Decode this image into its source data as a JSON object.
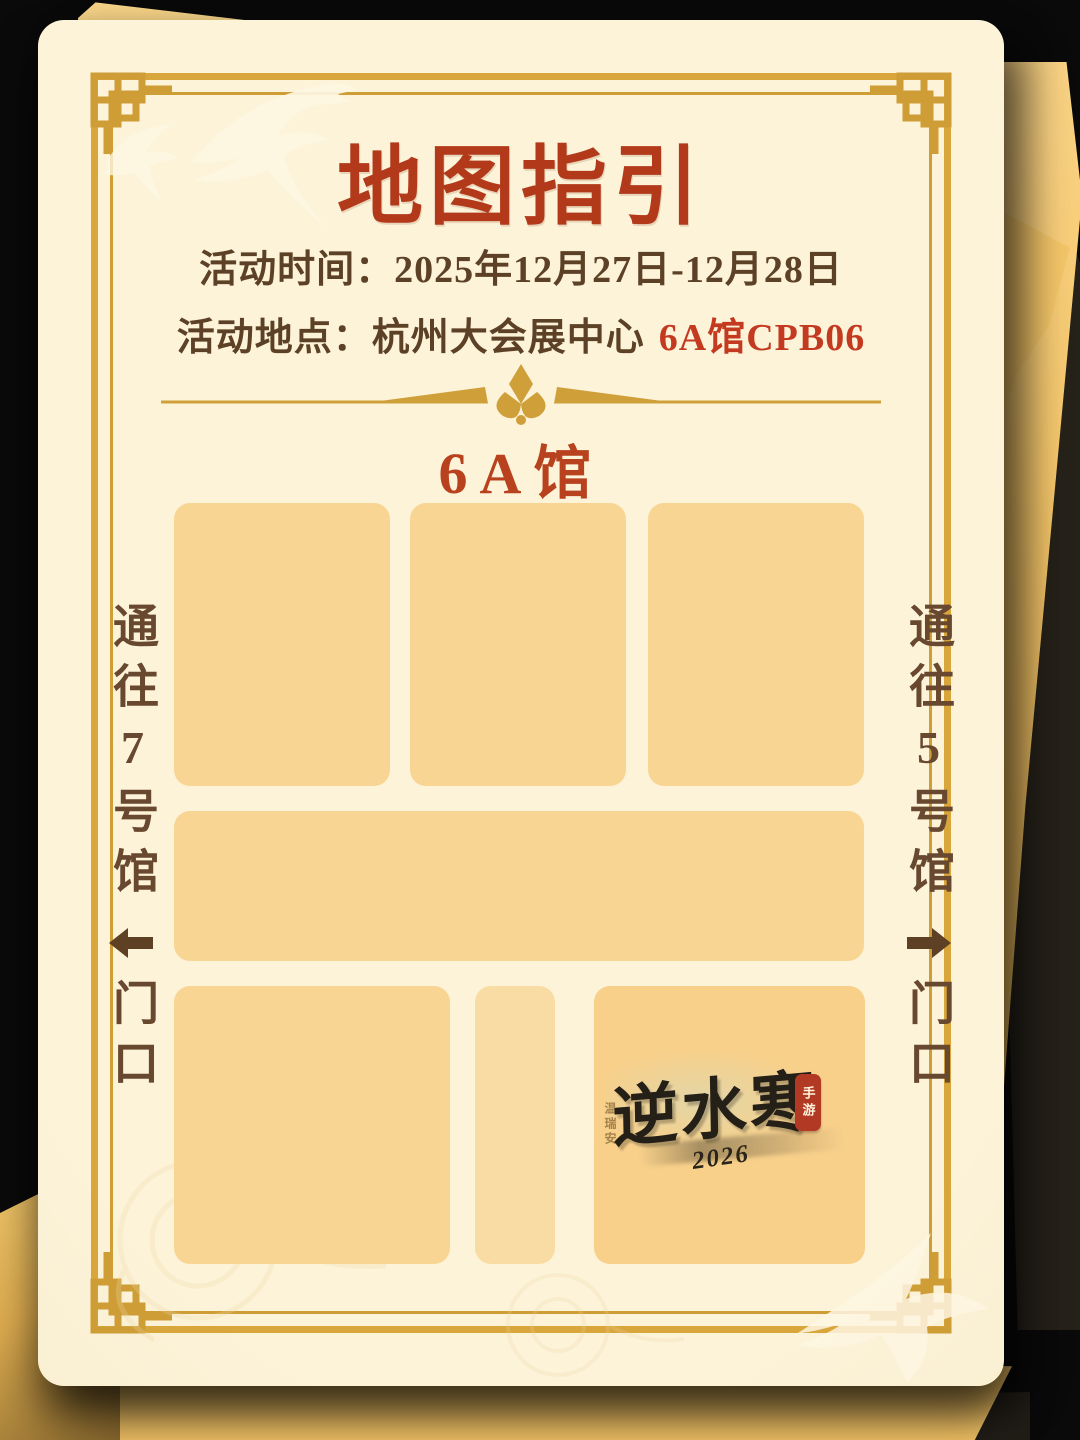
{
  "poster": {
    "title": "地图指引",
    "event": {
      "time_label": "活动时间：",
      "time_value": "2025年12月27日-12月28日",
      "place_label": "活动地点：",
      "place_value": "杭州大会展中心",
      "place_highlight": "6A馆CPB06"
    },
    "hall_title": "6A馆",
    "nav": {
      "left": {
        "to": "通往7号馆",
        "entrance": "门口",
        "direction": "left"
      },
      "right": {
        "to": "通往5号馆",
        "entrance": "门口",
        "direction": "right"
      }
    },
    "map_blocks": [
      {
        "id": "booth-top-1"
      },
      {
        "id": "booth-top-2"
      },
      {
        "id": "booth-top-3"
      },
      {
        "id": "booth-middle-wide"
      },
      {
        "id": "booth-bottom-left"
      },
      {
        "id": "booth-bottom-narrow"
      },
      {
        "id": "booth-bottom-logo"
      }
    ],
    "logo": {
      "name": "逆水寒",
      "year": "2026",
      "seal": "手游",
      "signature": "温瑞安"
    },
    "colors": {
      "title_red": "#B23A1B",
      "highlight_red": "#C43A20",
      "hall_red": "#B8421E",
      "text_brown": "#5C4126",
      "nav_brown": "#684930",
      "frame_gold": "#D9A63C",
      "divider_gold": "#CFA03A",
      "block_fill": "#F9D593",
      "card_cream": "#FBF0D3",
      "sheet_orange": "#F5C566",
      "seal_red": "#B23A24",
      "background": "#0A0A0A"
    }
  }
}
